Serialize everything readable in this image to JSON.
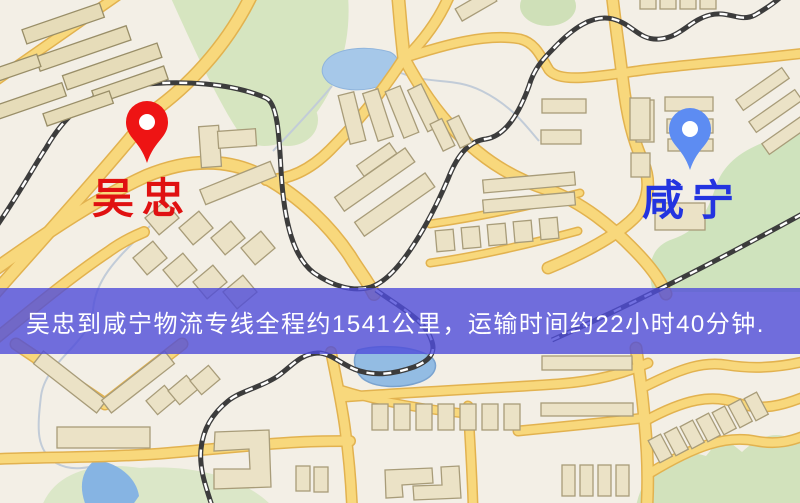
{
  "banner": {
    "text": "吴忠到咸宁物流专线全程约1541公里，运输时间约22小时40分钟.",
    "bg_color": "#4f4cda",
    "text_color": "#ffffff"
  },
  "route": {
    "distance_text": "约1541公里",
    "time_text": "约22小时40分钟"
  },
  "pins": {
    "origin": {
      "label": "吴忠",
      "pin_color": "#ee1414",
      "label_color": "#e01111"
    },
    "destination": {
      "label": "咸宁",
      "pin_color": "#5d8cf2",
      "label_color": "#2334e0"
    }
  },
  "map_colors": {
    "background": "#f3efe6",
    "road_fill": "#f8d87c",
    "road_casing": "#e2b24f",
    "water": "#a6c8e9",
    "pond": "#93bce3",
    "park": "#d6e5c0",
    "building": "#ebe2c6",
    "building_outline": "#a89c79",
    "railway": "#3c3c3c"
  }
}
